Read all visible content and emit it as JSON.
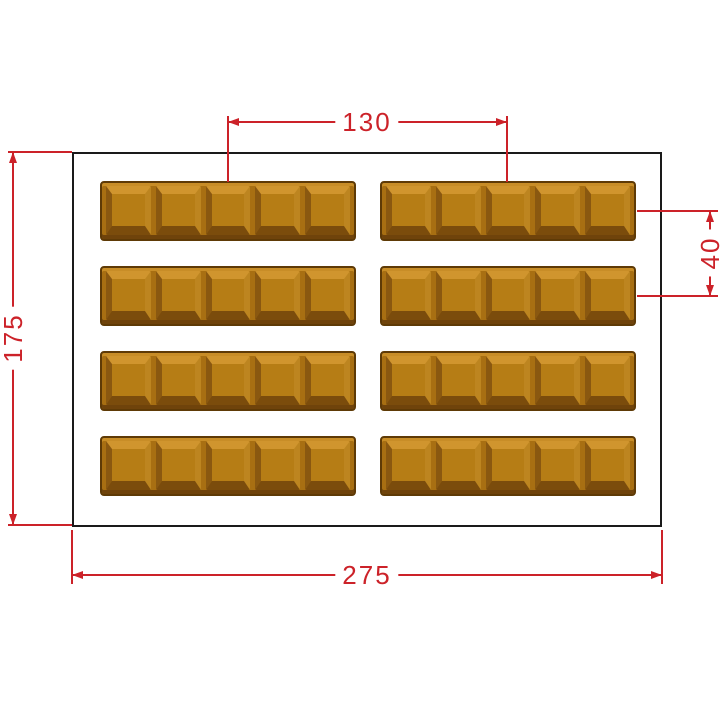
{
  "page": {
    "background": "#ffffff"
  },
  "drawing": {
    "type": "technical-drawing",
    "subject": "chocolate-bar-mold-top-view",
    "outline_color": "#1a1a1a",
    "dimension_color": "#cc2229",
    "grid": {
      "rows": 4,
      "columns": 2,
      "bars_total": 8,
      "segments_per_bar": 5
    },
    "chocolate_colors": {
      "outline": "#5e3a06",
      "base": "#a86f12",
      "face": "#b67d15",
      "highlight": "#d0952e",
      "shadow": "#7b4c0c"
    },
    "dimensions": {
      "column_spacing": {
        "value": "130",
        "orientation": "horizontal",
        "measures": "bar center-to-center, columns"
      },
      "row_spacing": {
        "value": "40",
        "orientation": "vertical",
        "measures": "bar center-to-center, rows"
      },
      "overall_width": {
        "value": "275",
        "orientation": "horizontal",
        "measures": "mold outline width"
      },
      "overall_height": {
        "value": "175",
        "orientation": "vertical",
        "measures": "mold outline height"
      }
    }
  }
}
